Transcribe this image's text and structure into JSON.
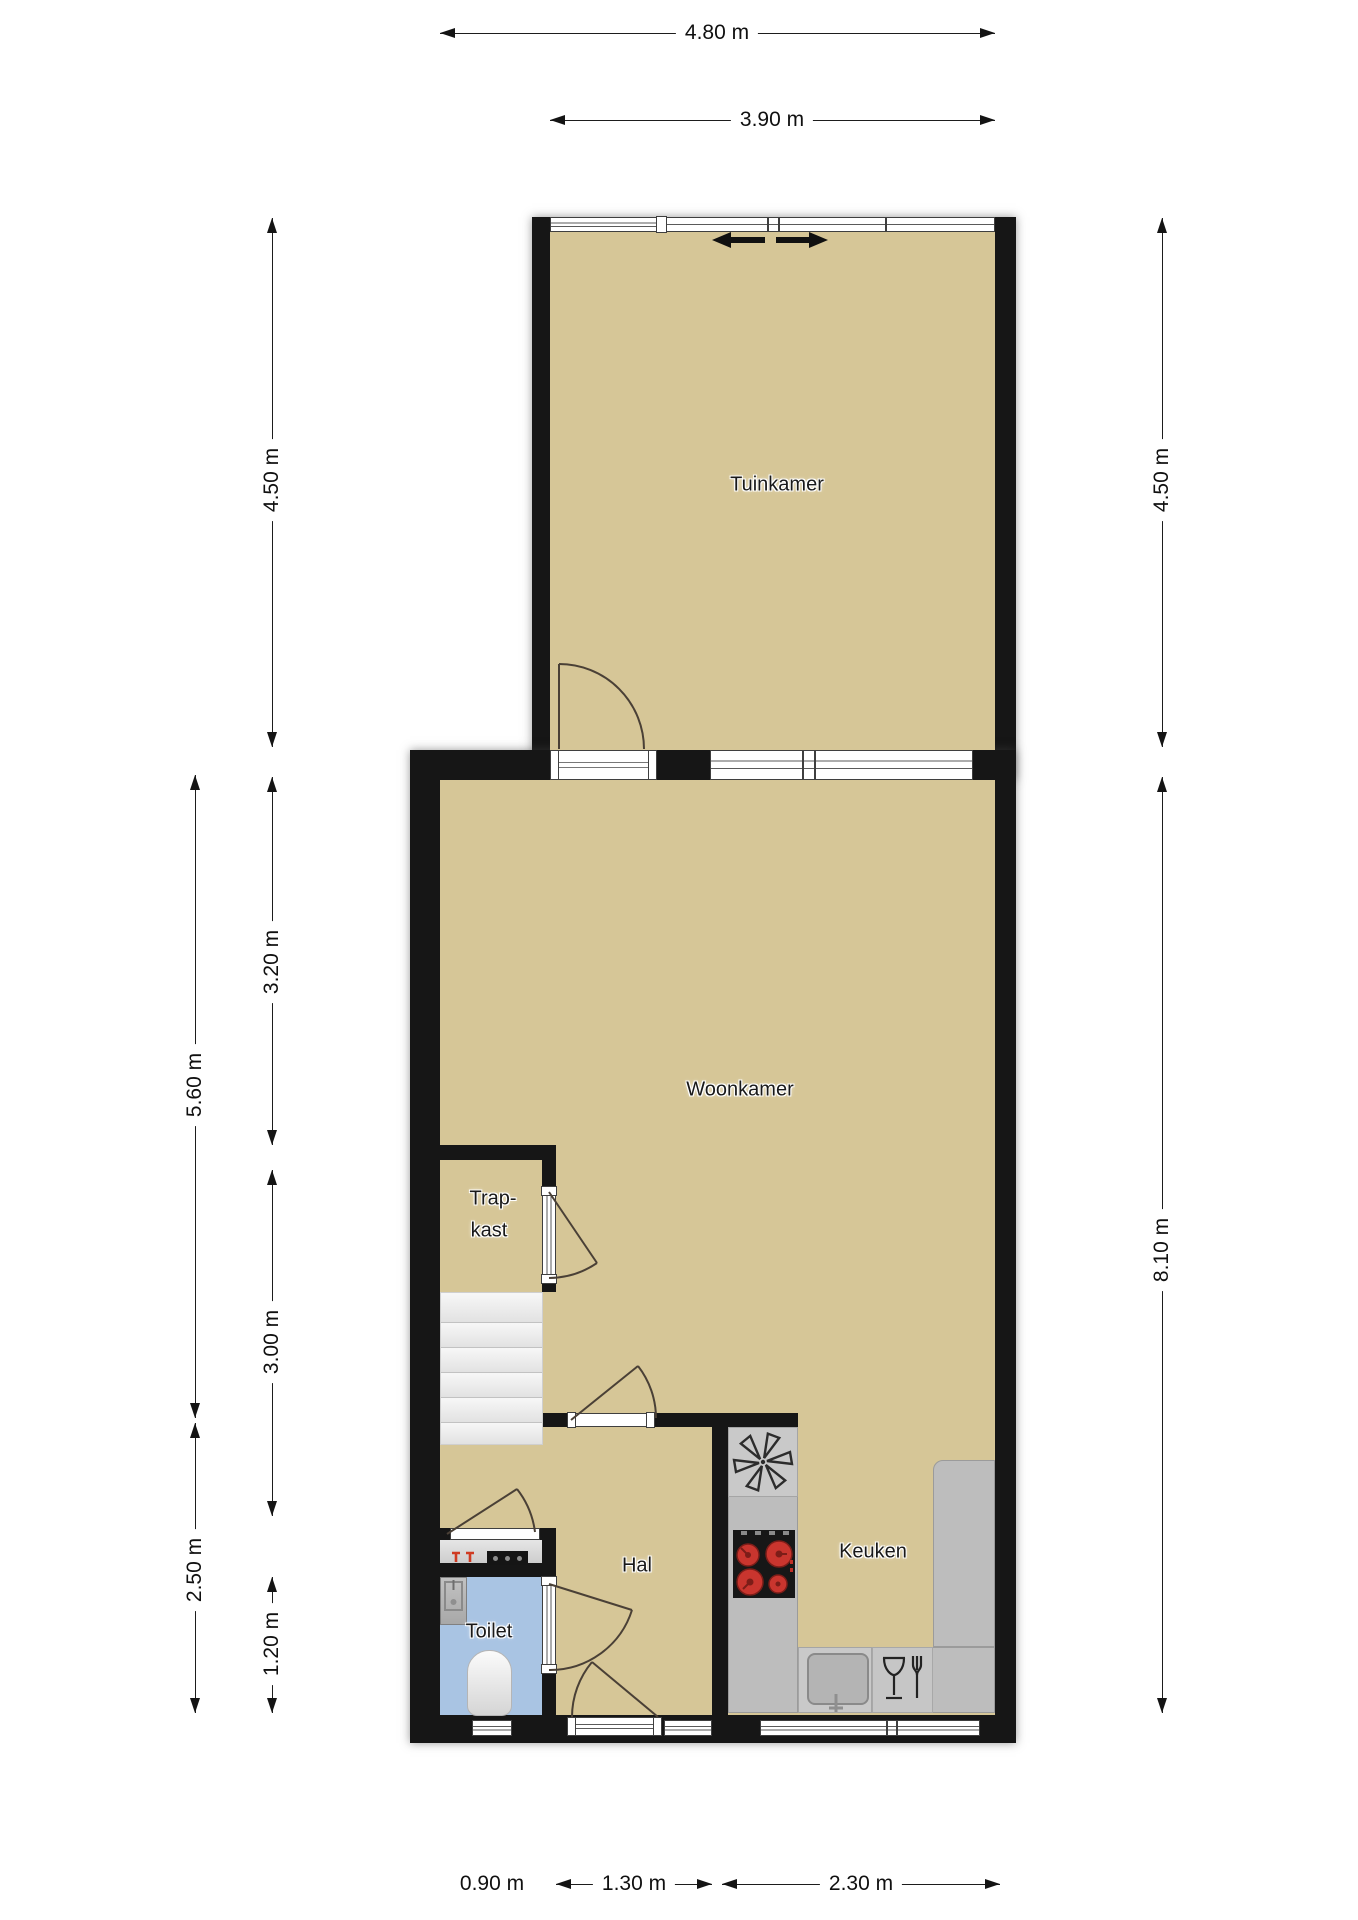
{
  "title": "Floor plan ground floor",
  "rooms": {
    "tuinkamer": {
      "label": "Tuinkamer"
    },
    "woonkamer": {
      "label": "Woonkamer"
    },
    "trapkast": {
      "line1": "Trap-",
      "line2": "kast"
    },
    "hal": {
      "label": "Hal"
    },
    "toilet": {
      "label": "Toilet"
    },
    "keuken": {
      "label": "Keuken"
    }
  },
  "dimensions": {
    "top": [
      {
        "label": "4.80 m"
      },
      {
        "label": "3.90 m"
      }
    ],
    "left_inner": [
      {
        "label": "4.50 m"
      },
      {
        "label": "3.20 m"
      },
      {
        "label": "3.00 m"
      },
      {
        "label": "1.20 m"
      }
    ],
    "left_outer": [
      {
        "label": "5.60 m"
      },
      {
        "label": "2.50 m"
      }
    ],
    "right": [
      {
        "label": "4.50 m"
      },
      {
        "label": "8.10 m"
      }
    ],
    "bottom": [
      {
        "label": "0.90 m"
      },
      {
        "label": "1.30 m"
      },
      {
        "label": "2.30 m"
      }
    ]
  },
  "icons": {
    "sliding_door": "sliding-door-arrows",
    "ventilation": "ventilation-fan-icon",
    "stove": "stove-burners-icon",
    "sink": "kitchen-sink-icon",
    "dishwasher": "dishwasher-glass-fork-icon",
    "washbasin": "washbasin-icon",
    "toilet_bowl": "toilet-bowl-icon",
    "meter_box": "meter-box-icon",
    "taps": "red-tap-icons"
  },
  "colors": {
    "wall": "#161616",
    "floor": "#d6c697",
    "toilet_floor": "#a9c4e3",
    "stairs": "#efefef",
    "counter": "#bdbdbd",
    "counter_light": "#c9c9c9",
    "stove": "#171717",
    "burner": "#c9352e",
    "accent_red": "#cf3b22",
    "frame": "#3f3f3f",
    "arc": "#4a4036"
  }
}
